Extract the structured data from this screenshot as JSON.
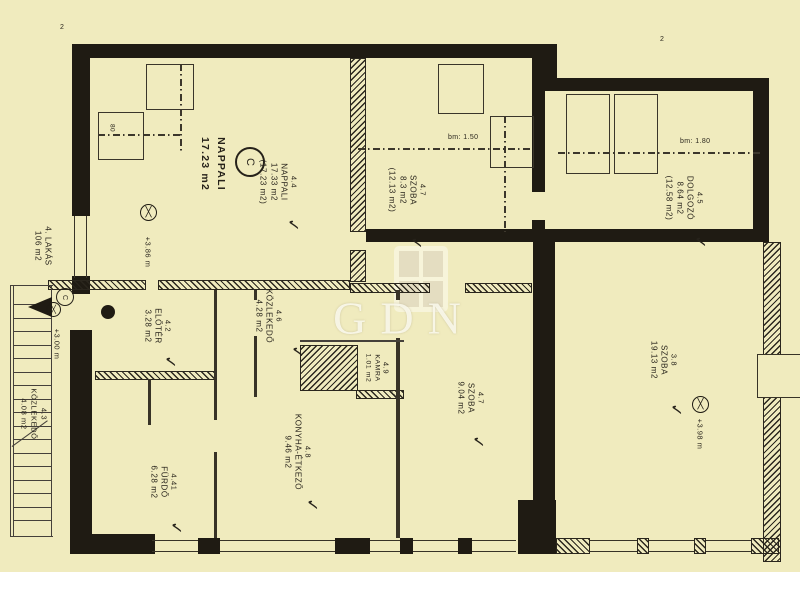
{
  "document": {
    "type": "apartment floor plan (scanned)",
    "unit_label": {
      "line1": "4. LAKÁS",
      "line2": "106 m2"
    }
  },
  "watermark": {
    "text": "GDN"
  },
  "marks": {
    "check": "✓",
    "section": "2",
    "bed_size": "80",
    "circle_main": "C",
    "circle_small": "C",
    "cross": "╳"
  },
  "levels": {
    "nappali": "+3.86 m",
    "entry": "+3.00 m",
    "szoba_right": "+3.98 m"
  },
  "ceiling_lines": {
    "szoba_top": "bm: 1.50",
    "dolgozo": "bm: 1.80"
  },
  "rooms": {
    "nappali_big": {
      "name": "NAPPALI",
      "area": "17.23 m2"
    },
    "nappali": {
      "id": "4.4",
      "name": "NAPPALI",
      "area": "17.33 m2",
      "area_note": "(17.23 m2)"
    },
    "szoba_top": {
      "id": "4.7",
      "name": "SZOBA",
      "area": "8.3 m2",
      "area_note": "(12.13 m2)"
    },
    "dolgozo": {
      "id": "4.5",
      "name": "DOLGOZÓ",
      "area": "8.64 m2",
      "area_note": "(12.58 m2)"
    },
    "eloter": {
      "id": "4.2",
      "name": "ELŐTÉR",
      "area": "3.28 m2"
    },
    "kozlekedo_stairs": {
      "id": "4.3",
      "name": "KÖZLEKEDŐ",
      "area": "4.08 m2"
    },
    "kozlekedo": {
      "id": "4.6",
      "name": "KÖZLEKEDŐ",
      "area": "4.28 m2"
    },
    "kamra": {
      "id": "4.9",
      "name": "KAMRA",
      "area": "1.01 m2"
    },
    "konyha": {
      "id": "4.8",
      "name": "KONYHA-ÉTKEZŐ",
      "area": "9.46 m2"
    },
    "furdo": {
      "id": "4.41",
      "name": "FÜRDŐ",
      "area": "6.28 m2"
    },
    "szoba_mid": {
      "id": "4.7",
      "name": "SZOBA",
      "area": "9.04 m2"
    },
    "szoba_right": {
      "id": "3.8",
      "name": "SZOBA",
      "area": "19.13 m2"
    }
  },
  "colors": {
    "paper": "#f0ebbe",
    "ink": "#1f1b13",
    "watermark": "#fdfbf0"
  }
}
